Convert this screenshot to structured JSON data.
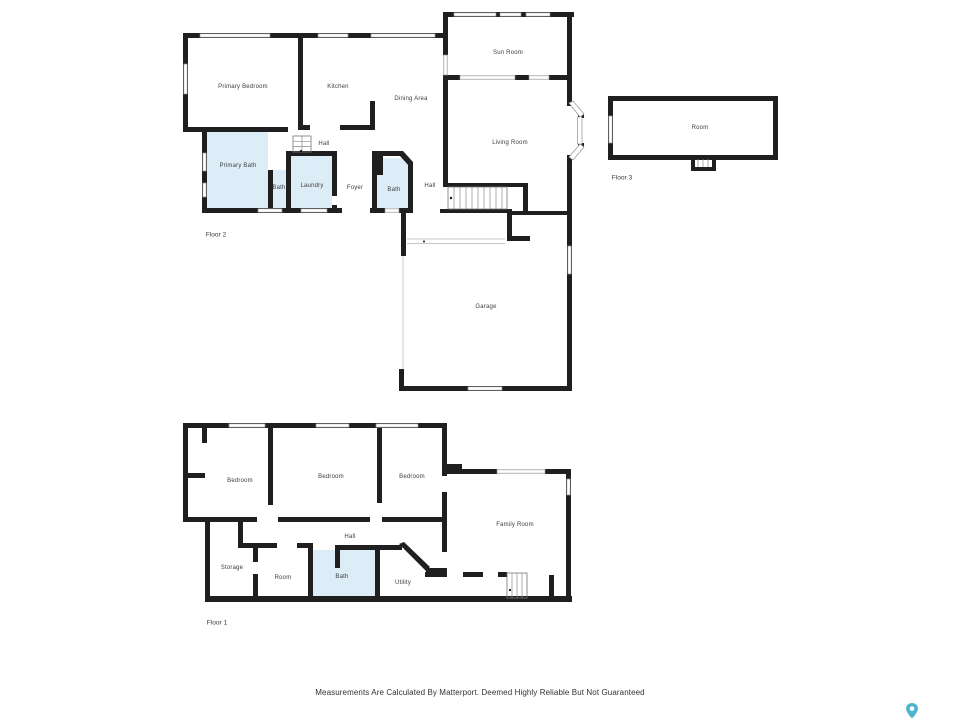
{
  "page": {
    "background": "#ffffff"
  },
  "disclaimer": "Measurements Are Calculated By Matterport. Deemed Highly Reliable But Not Guaranteed",
  "branding": {
    "icon": "matterport-pin-icon",
    "color": "#4db4cb"
  },
  "palette": {
    "wall": "#1f1f1f",
    "bath_fill": "#ddedf7",
    "window_stroke": "#939393"
  },
  "floors": [
    {
      "caption": "Floor 2",
      "caption_pos": {
        "x": 216,
        "y": 236
      },
      "rooms": [
        {
          "label": "Primary Bedroom",
          "x": 243,
          "y": 87
        },
        {
          "label": "Kitchen",
          "x": 338,
          "y": 87
        },
        {
          "label": "Dining Area",
          "x": 411,
          "y": 99
        },
        {
          "label": "Sun Room",
          "x": 508,
          "y": 53
        },
        {
          "label": "Living Room",
          "x": 510,
          "y": 143
        },
        {
          "label": "Hall",
          "x": 324,
          "y": 144
        },
        {
          "label": "Primary Bath",
          "x": 238,
          "y": 166
        },
        {
          "label": "Bath",
          "x": 279,
          "y": 188
        },
        {
          "label": "Laundry",
          "x": 312,
          "y": 186
        },
        {
          "label": "Foyer",
          "x": 355,
          "y": 188
        },
        {
          "label": "Bath",
          "x": 394,
          "y": 190
        },
        {
          "label": "Hall",
          "x": 430,
          "y": 186
        },
        {
          "label": "Garage",
          "x": 486,
          "y": 307
        }
      ]
    },
    {
      "caption": "Floor 3",
      "caption_pos": {
        "x": 622,
        "y": 179
      },
      "rooms": [
        {
          "label": "Room",
          "x": 700,
          "y": 128
        }
      ]
    },
    {
      "caption": "Floor 1",
      "caption_pos": {
        "x": 217,
        "y": 624
      },
      "rooms": [
        {
          "label": "Bedroom",
          "x": 240,
          "y": 481
        },
        {
          "label": "Bedroom",
          "x": 331,
          "y": 477
        },
        {
          "label": "Bedroom",
          "x": 412,
          "y": 477
        },
        {
          "label": "Family Room",
          "x": 515,
          "y": 525
        },
        {
          "label": "Hall",
          "x": 350,
          "y": 537
        },
        {
          "label": "Storage",
          "x": 232,
          "y": 568
        },
        {
          "label": "Room",
          "x": 283,
          "y": 578
        },
        {
          "label": "Bath",
          "x": 342,
          "y": 577
        },
        {
          "label": "Utility",
          "x": 403,
          "y": 583
        }
      ]
    }
  ]
}
